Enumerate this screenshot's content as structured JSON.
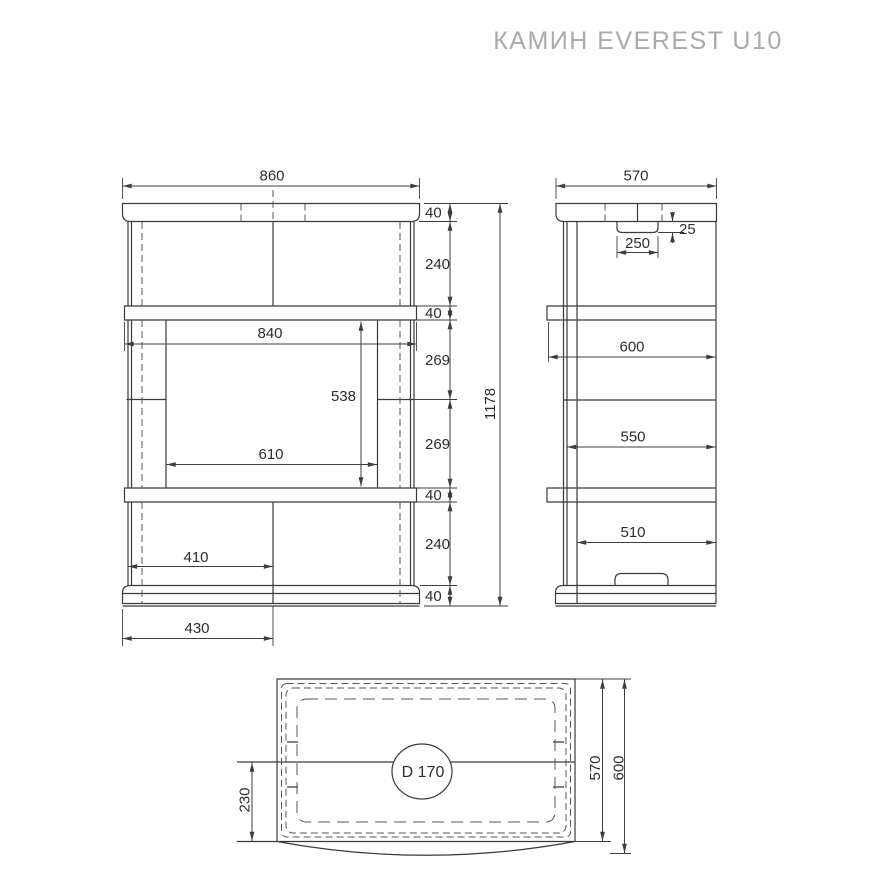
{
  "title": "КАМИН EVEREST U10",
  "front_view": {
    "width": "860",
    "shelf_width": "840",
    "opening_width": "610",
    "opening_height": "538",
    "hearth_left_width": "410",
    "base_left_width": "430",
    "total_height": "1178",
    "height_chain": [
      "40",
      "240",
      "40",
      "269",
      "269",
      "40",
      "240",
      "40"
    ]
  },
  "side_view": {
    "depth": "570",
    "flue_notch_width": "250",
    "flue_notch_depth": "25",
    "shelf_depth": "600",
    "body_depth": "550",
    "base_depth": "510"
  },
  "top_view": {
    "flue_diameter": "D 170",
    "flue_center_offset": "230",
    "depth_inner": "570",
    "depth_outer": "600"
  }
}
